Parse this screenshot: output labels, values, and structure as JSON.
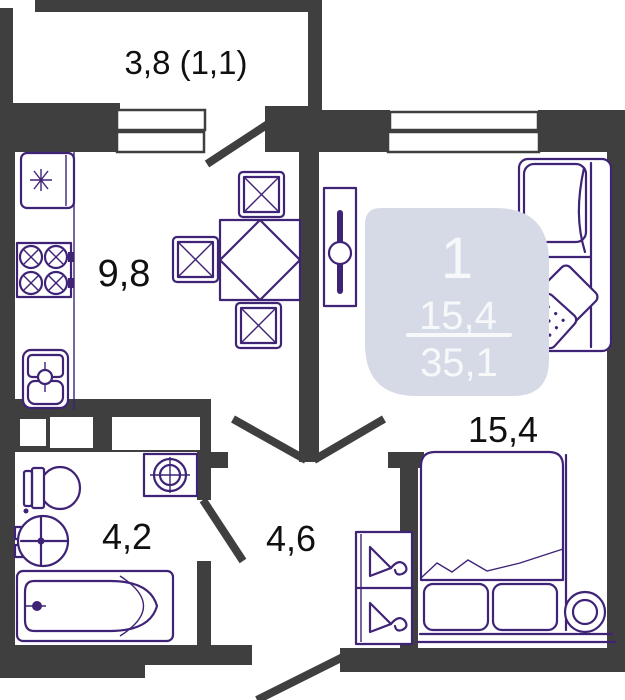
{
  "plan": {
    "type_badge": {
      "rooms_count": "1",
      "living_area": "15,4",
      "total_area": "35,1"
    },
    "labels": {
      "balcony": "3,8 (1,1)",
      "kitchen": "9,8",
      "living_room": "15,4",
      "bathroom": "4,2",
      "hallway": "4,6"
    },
    "colors": {
      "wall": "#3f3f3f",
      "furniture": "#3e2376",
      "badge_bg": "#d6dae6",
      "badge_text": "#f7f8fa",
      "label_text": "#101010",
      "floor": "#ffffff"
    }
  }
}
